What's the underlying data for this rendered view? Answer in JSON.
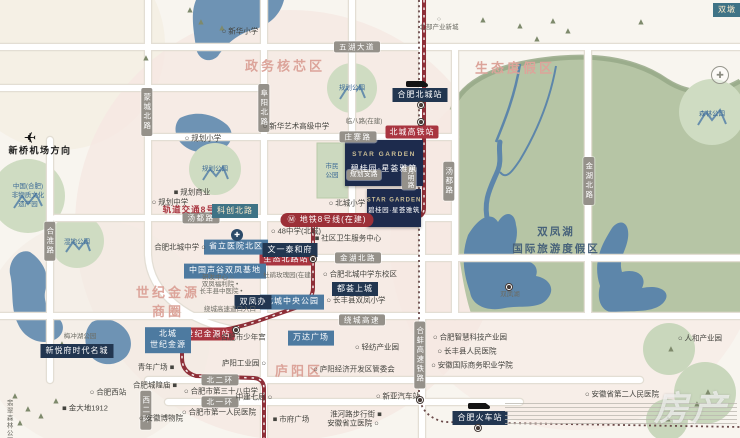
{
  "canvas": {
    "w": 740,
    "h": 438
  },
  "palette": {
    "background": "#f8f5ef",
    "blush_zone": "#f5e7e1",
    "green_resort": "#b6c5a5",
    "lake_blue": "#5d86aa",
    "road_white": "#ffffff",
    "metro_red": "#8e2f38",
    "station_red": "#a93540",
    "navy_label": "#223650",
    "blue_label": "#4d7aa0",
    "region_pink": "#dca49a",
    "park_circle": "#cfdcc2"
  },
  "watermark": "房产",
  "map": {
    "labels": [
      {
        "n": "region-title-government-core",
        "c": "region",
        "t": "政务核芯区",
        "x": 285,
        "y": 67
      },
      {
        "n": "region-title-eco-resort",
        "c": "region",
        "t": "生态度假区",
        "x": 515,
        "y": 69
      },
      {
        "n": "region-title-shiji-jinyuan-cbd",
        "c": "region",
        "t": "世纪金源\n商圈",
        "x": 168,
        "y": 303
      },
      {
        "n": "region-title-luyang-district",
        "c": "region",
        "t": "庐阳区",
        "x": 299,
        "y": 372
      },
      {
        "n": "region-title-shuangfeng-lake-resort",
        "c": "lake-title",
        "t": "双凤湖\n国际旅游度假区",
        "x": 556,
        "y": 241
      },
      {
        "n": "road-wuhu-avenue",
        "c": "pill",
        "t": "五湖大道",
        "x": 357,
        "y": 47
      },
      {
        "n": "road-mengcheng-north",
        "c": "pill v",
        "t": "蒙城北路",
        "x": 147,
        "y": 112
      },
      {
        "n": "road-fuyang-north",
        "c": "pill v",
        "t": "阜阳北路",
        "x": 264,
        "y": 108
      },
      {
        "n": "road-hehuai-road",
        "c": "pill v",
        "t": "合淮路",
        "x": 50,
        "y": 241
      },
      {
        "n": "road-zhuangzhai-road",
        "c": "pill",
        "t": "庄寨路",
        "x": 358,
        "y": 137
      },
      {
        "n": "road-linba-road",
        "c": "small",
        "t": "临八路(在建)",
        "x": 364,
        "y": 122
      },
      {
        "n": "road-tangdu-road-h",
        "c": "pill",
        "t": "汤都路",
        "x": 201,
        "y": 218
      },
      {
        "n": "road-tangdu-road-v",
        "c": "pill v",
        "t": "汤都路",
        "x": 449,
        "y": 181
      },
      {
        "n": "road-jinhu-north-v",
        "c": "pill v",
        "t": "金湖北路",
        "x": 589,
        "y": 181
      },
      {
        "n": "road-jinhu-north-h",
        "c": "pill",
        "t": "金湖北路",
        "x": 358,
        "y": 258
      },
      {
        "n": "road-ring-expressway",
        "c": "pill",
        "t": "绕城高速",
        "x": 362,
        "y": 320
      },
      {
        "n": "road-north-2nd-ring",
        "c": "pill",
        "t": "北二环",
        "x": 220,
        "y": 380
      },
      {
        "n": "road-north-1st-ring",
        "c": "pill",
        "t": "北一环",
        "x": 220,
        "y": 402
      },
      {
        "n": "road-west-2nd-ring",
        "c": "pill v",
        "t": "西二环",
        "x": 146,
        "y": 410
      },
      {
        "n": "road-planned-branch",
        "c": "pill sm",
        "t": "规划支路",
        "x": 364,
        "y": 175
      },
      {
        "n": "road-yueming-road",
        "c": "pill v sm",
        "t": "月明路",
        "x": 409,
        "y": 178
      },
      {
        "n": "rail-hebeng-hsr",
        "c": "pill v",
        "t": "合蚌高速铁路",
        "x": 420,
        "y": 355
      },
      {
        "n": "metro-line8-text",
        "c": "redtext",
        "t": "轨道交通8号线",
        "x": 194,
        "y": 210
      },
      {
        "n": "metro-line8-banner",
        "c": "redbanner",
        "t": "Ⓜ 地铁8号线(在建)",
        "x": 327,
        "y": 220
      },
      {
        "n": "station-beicheng-hsr",
        "c": "red",
        "t": "北城高铁站",
        "x": 412,
        "y": 132
      },
      {
        "n": "station-shengtai-north-road",
        "c": "red",
        "t": "生态北路站",
        "x": 286,
        "y": 259
      },
      {
        "n": "station-shiji-jinyuan",
        "c": "red",
        "t": "世纪金源站",
        "x": 208,
        "y": 334
      },
      {
        "n": "station-hefei-beicheng-rail",
        "c": "navy",
        "t": "合肥北城站",
        "x": 420,
        "y": 95
      },
      {
        "n": "label-kechuang-north-road",
        "c": "teal",
        "t": "科创北路",
        "x": 235,
        "y": 211
      },
      {
        "n": "label-provincial-hospital-north",
        "c": "blue",
        "t": "省立医院北区",
        "x": 236,
        "y": 247
      },
      {
        "n": "label-china-speech-valley",
        "c": "blue",
        "t": "中国声谷双凤基地",
        "x": 225,
        "y": 271
      },
      {
        "n": "label-wenyi-taihefu",
        "c": "navy",
        "t": "文一泰和府",
        "x": 290,
        "y": 250
      },
      {
        "n": "label-duhui-shangcheng",
        "c": "navy",
        "t": "都荟上城",
        "x": 355,
        "y": 289
      },
      {
        "n": "label-beicheng-central-park",
        "c": "blue",
        "t": "北城中央公园",
        "x": 292,
        "y": 302
      },
      {
        "n": "label-shuangfeng-office",
        "c": "navy",
        "t": "双凤办",
        "x": 253,
        "y": 302
      },
      {
        "n": "label-beicheng-shiji-jinyuan",
        "c": "blue",
        "t": "北城\n世纪金源",
        "x": 168,
        "y": 340
      },
      {
        "n": "label-wanda-plaza",
        "c": "blue",
        "t": "万达广场",
        "x": 311,
        "y": 338
      },
      {
        "n": "label-xinyuefu-times-city",
        "c": "navy",
        "t": "新悦府时代名城",
        "x": 77,
        "y": 351
      },
      {
        "n": "label-hefei-railway-station",
        "c": "navy",
        "t": "合肥火车站",
        "x": 480,
        "y": 418
      },
      {
        "n": "starbox-main-bg",
        "c": "starbg lg",
        "t": "",
        "x": 384,
        "y": 163
      },
      {
        "n": "starbox-main-en",
        "c": "staren",
        "t": "STAR GARDEN",
        "x": 384,
        "y": 155
      },
      {
        "n": "starbox-main-cn",
        "c": "starcn",
        "t": "碧桂园·星荟雅筑",
        "x": 384,
        "y": 169
      },
      {
        "n": "starbox-south-bg",
        "c": "starbg sm2",
        "t": "",
        "x": 394,
        "y": 208
      },
      {
        "n": "starbox-south-en",
        "c": "staren sm2",
        "t": "STAR GARDEN",
        "x": 394,
        "y": 201
      },
      {
        "n": "starbox-south-cn",
        "c": "starcn sm2",
        "t": "碧桂园·星荟雅筑",
        "x": 394,
        "y": 211
      },
      {
        "n": "poi-xinhua-primary",
        "c": "poi",
        "t": "○ 新华小学",
        "x": 240,
        "y": 31
      },
      {
        "n": "poi-north-industry-newtown",
        "c": "small",
        "t": "○\n北部产业新城",
        "x": 439,
        "y": 24
      },
      {
        "n": "poi-planned-primary",
        "c": "poi",
        "t": "○ 规划小学",
        "x": 203,
        "y": 138
      },
      {
        "n": "poi-planned-commerce",
        "c": "poi",
        "t": "■ 规划商业",
        "x": 192,
        "y": 192
      },
      {
        "n": "poi-planned-middle",
        "c": "poi",
        "t": "○ 规划中学",
        "x": 170,
        "y": 202
      },
      {
        "n": "poi-xinhua-art-school",
        "c": "poi",
        "t": "○ 新华艺术高级中学",
        "x": 296,
        "y": 126
      },
      {
        "n": "poi-beicheng-middle",
        "c": "poi",
        "t": "合肥北城中学 ○",
        "x": 180,
        "y": 247
      },
      {
        "n": "poi-no48-middle",
        "c": "poi",
        "t": "○ 48中学(北城)",
        "x": 296,
        "y": 231
      },
      {
        "n": "poi-community-health-center",
        "c": "poi",
        "t": "■ 社区卫生服务中心",
        "x": 348,
        "y": 238
      },
      {
        "n": "poi-rose-garden",
        "c": "small",
        "t": "杜鹃玫瑰园(在建)",
        "x": 288,
        "y": 276
      },
      {
        "n": "poi-beicheng-primary",
        "c": "poi",
        "t": "○ 北城小学",
        "x": 347,
        "y": 203
      },
      {
        "n": "poi-beicheng-middle-east",
        "c": "poi",
        "t": "○ 合肥北城中学东校区",
        "x": 360,
        "y": 274
      },
      {
        "n": "poi-shuangfeng-primary",
        "c": "poi",
        "t": "○ 长丰县双凤小学",
        "x": 356,
        "y": 300
      },
      {
        "n": "poi-rd-center",
        "c": "small",
        "t": "研发中心 ○",
        "x": 218,
        "y": 278
      },
      {
        "n": "poi-shuangfeng-welfare",
        "c": "small",
        "t": "双凤福利院 •",
        "x": 220,
        "y": 285
      },
      {
        "n": "poi-changfeng-tcm-hospital",
        "c": "small",
        "t": "长丰县中医院 •",
        "x": 221,
        "y": 292
      },
      {
        "n": "poi-expressway-entrance",
        "c": "small",
        "t": "绕城高速道口入口",
        "x": 230,
        "y": 310
      },
      {
        "n": "poi-youth-palace",
        "c": "poi",
        "t": "○ 合肥市少年宫",
        "x": 240,
        "y": 337
      },
      {
        "n": "poi-meichong-lake-park",
        "c": "small",
        "t": "梅冲湖公园",
        "x": 80,
        "y": 337
      },
      {
        "n": "poi-hefei-west-station",
        "c": "poi",
        "t": "○ 合肥西站",
        "x": 108,
        "y": 392
      },
      {
        "n": "poi-jindadi-1912",
        "c": "poi",
        "t": "■ 金大地1912",
        "x": 85,
        "y": 408
      },
      {
        "n": "poi-anhui-museum",
        "c": "poi",
        "t": "○ 安徽博物院",
        "x": 161,
        "y": 418
      },
      {
        "n": "poi-city-god-temple",
        "c": "poi",
        "t": "合肥城隍庙 ■",
        "x": 155,
        "y": 385
      },
      {
        "n": "poi-youth-plaza",
        "c": "poi",
        "t": "青年广场 ■",
        "x": 156,
        "y": 367
      },
      {
        "n": "poi-luyang-industrial-park",
        "c": "poi",
        "t": "庐阳工业园 ○",
        "x": 244,
        "y": 363
      },
      {
        "n": "poi-no38-middle",
        "c": "poi",
        "t": "○ 合肥市第三十八中学",
        "x": 221,
        "y": 391
      },
      {
        "n": "poi-zhongjian-7th-bureau",
        "c": "poi",
        "t": "中建七局 ○",
        "x": 254,
        "y": 397
      },
      {
        "n": "poi-first-peoples-hospital",
        "c": "poi",
        "t": "○ 合肥市第一人民医院",
        "x": 219,
        "y": 412
      },
      {
        "n": "poi-government-plaza",
        "c": "poi",
        "t": "■ 市府广场",
        "x": 291,
        "y": 419
      },
      {
        "n": "poi-huaihe-walking-street",
        "c": "poi",
        "t": "淮河路步行街 ■",
        "x": 356,
        "y": 414
      },
      {
        "n": "poi-provincial-hospital",
        "c": "poi",
        "t": "安徽省立医院 ○",
        "x": 353,
        "y": 423
      },
      {
        "n": "poi-textile-industry-park",
        "c": "poi",
        "t": "○ 轻纺产业园",
        "x": 377,
        "y": 347
      },
      {
        "n": "poi-luyang-edz-committee",
        "c": "poi",
        "t": "○ 庐阳经济开发区管委会",
        "x": 354,
        "y": 369
      },
      {
        "n": "poi-xinya-bus-station",
        "c": "poi",
        "t": "○ 新亚汽车站",
        "x": 398,
        "y": 396
      },
      {
        "n": "poi-smart-tech-park",
        "c": "poi",
        "t": "○ 合肥智慧科技产业园",
        "x": 470,
        "y": 337
      },
      {
        "n": "poi-changfeng-peoples-hospital",
        "c": "poi",
        "t": "○ 长丰县人民医院",
        "x": 467,
        "y": 351
      },
      {
        "n": "poi-intl-business-college",
        "c": "poi",
        "t": "○ 安徽国际商务职业学院",
        "x": 472,
        "y": 365
      },
      {
        "n": "poi-renhe-industry-park",
        "c": "poi",
        "t": "○ 人和产业园",
        "x": 700,
        "y": 338
      },
      {
        "n": "poi-second-peoples-hospital",
        "c": "poi",
        "t": "○ 安徽省第二人民医院",
        "x": 622,
        "y": 394
      },
      {
        "n": "poi-shuangfeng-lake",
        "c": "small",
        "t": "双凤湖",
        "x": 510,
        "y": 295
      },
      {
        "n": "label-xinqiao-airport-direction",
        "c": "airport",
        "t": "新桥机场方向",
        "x": 40,
        "y": 151
      },
      {
        "n": "poi-feicui-forest-park",
        "c": "small v",
        "t": "翡翠森林公园",
        "x": 8,
        "y": 422
      },
      {
        "n": "park-intangible-heritage",
        "c": "parktext",
        "t": "中国(合肥)\n非物质文化\n遗产园",
        "x": 28,
        "y": 196
      },
      {
        "n": "park-wetland",
        "c": "parktext",
        "t": "湿地公园",
        "x": 77,
        "y": 243
      },
      {
        "n": "park-planned-1",
        "c": "parktext",
        "t": "规划公园",
        "x": 215,
        "y": 170
      },
      {
        "n": "park-planned-2",
        "c": "parktext",
        "t": "规划公园",
        "x": 352,
        "y": 89
      },
      {
        "n": "park-forest",
        "c": "parktext",
        "t": "森林公园",
        "x": 712,
        "y": 115
      },
      {
        "n": "park-citizen",
        "c": "parktext",
        "t": "市民\n公园",
        "x": 332,
        "y": 172
      },
      {
        "n": "label-shuangdun",
        "c": "teal",
        "t": "双墩",
        "x": 727,
        "y": 10
      }
    ],
    "icons": [
      {
        "n": "airplane-icon",
        "c": "icon icon-plane",
        "t": "✈",
        "x": 30,
        "y": 138
      },
      {
        "n": "compass-icon",
        "c": "icon icon-compass",
        "t": "✚",
        "x": 720,
        "y": 75
      },
      {
        "n": "hospital-cross-icon",
        "c": "icon icon-cross",
        "t": "✚",
        "x": 237,
        "y": 235
      },
      {
        "n": "train-icon",
        "c": "icon icon-train",
        "t": "",
        "x": 417,
        "y": 84
      },
      {
        "n": "train-icon",
        "c": "icon icon-train",
        "t": "",
        "x": 479,
        "y": 406
      }
    ],
    "station_dots": [
      [
        421,
        105
      ],
      [
        421,
        122
      ],
      [
        313,
        259
      ],
      [
        236,
        330
      ],
      [
        420,
        400
      ],
      [
        478,
        428
      ],
      [
        509,
        287
      ]
    ],
    "trees": [
      [
        190,
        10
      ],
      [
        201,
        22
      ],
      [
        222,
        28
      ],
      [
        146,
        58
      ],
      [
        483,
        20
      ],
      [
        520,
        26
      ],
      [
        537,
        39
      ],
      [
        553,
        21
      ],
      [
        568,
        31
      ],
      [
        641,
        22
      ],
      [
        15,
        396
      ],
      [
        28,
        409
      ],
      [
        20,
        423
      ],
      [
        41,
        416
      ],
      [
        56,
        401
      ],
      [
        62,
        344
      ],
      [
        671,
        349
      ],
      [
        708,
        392
      ],
      [
        668,
        419
      ],
      [
        697,
        404
      ]
    ]
  }
}
